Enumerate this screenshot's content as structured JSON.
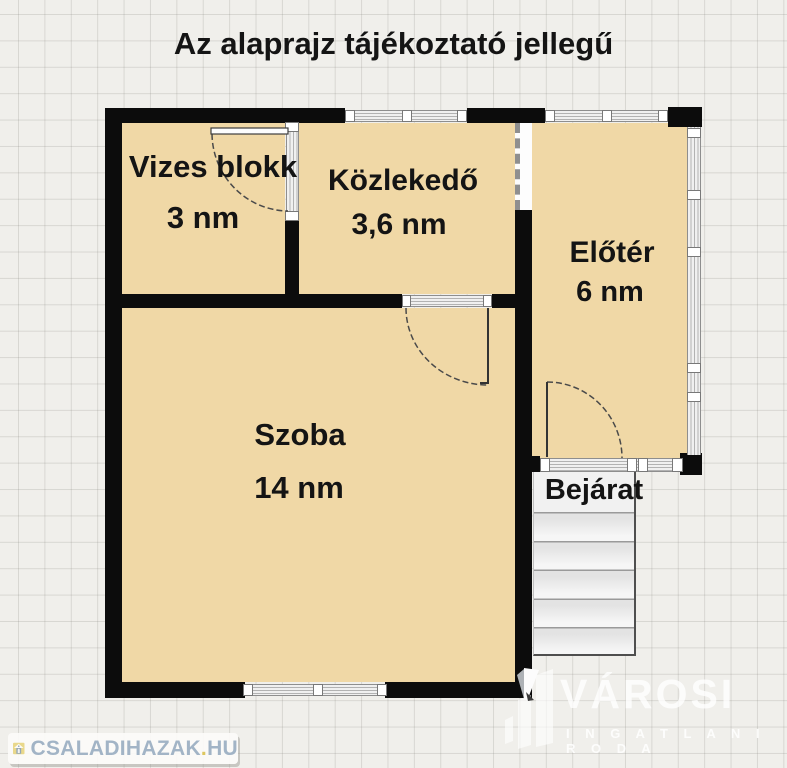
{
  "title": "Az alaprajz tájékoztató jellegű",
  "rooms": [
    {
      "name": "Vizes blokk",
      "area": "3 nm"
    },
    {
      "name": "Közlekedő",
      "area": "3,6 nm"
    },
    {
      "name": "Előtér",
      "area": "6 nm"
    },
    {
      "name": "Szoba",
      "area": "14 nm"
    }
  ],
  "entrance": {
    "label": "Bejárat"
  },
  "watermarks": {
    "portal": {
      "name": "CSALADIHAZAK",
      "dot": ".",
      "tld": "HU"
    },
    "agency": {
      "name": "VÁROSI",
      "subtitle": "I N G A T L A N I R O D A"
    }
  },
  "colors": {
    "background": "#f0efeb",
    "grid_line": "#dbdad6",
    "wall": "#0c0c0c",
    "room_fill": "#f0d8a6",
    "window_frame": "#8e8e8e",
    "portal_text": "#a2b4c6",
    "portal_dot": "#ddc75f",
    "agency_text": "#ffffff"
  }
}
